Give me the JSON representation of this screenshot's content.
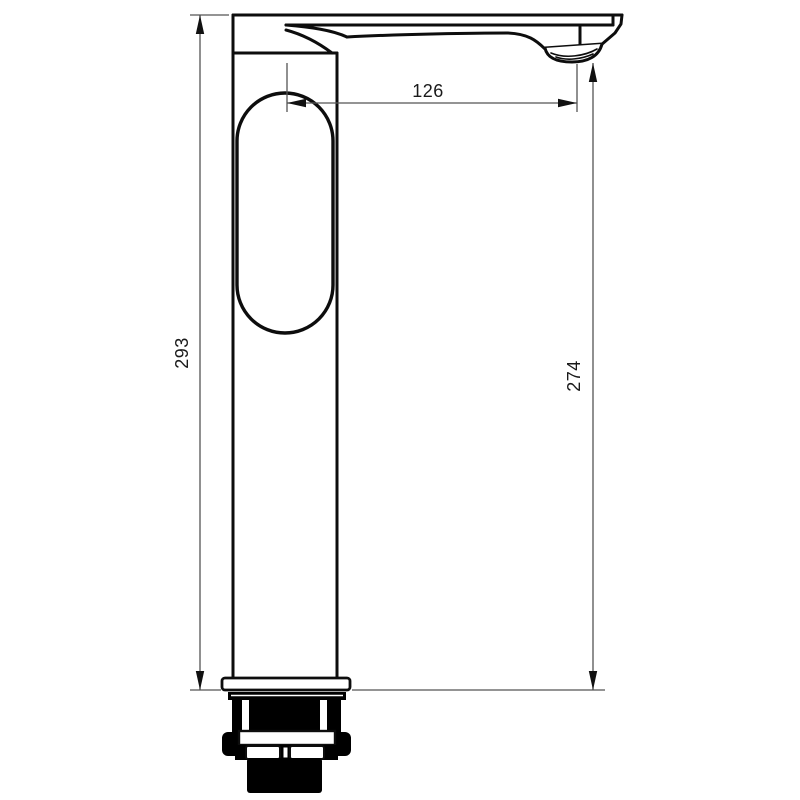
{
  "page": {
    "background": "#ffffff",
    "description": "Technical dimensioned drawing of a tall single-lever basin mixer tap, side view"
  },
  "drawing": {
    "subject": "Tall basin mixer tap - side elevation with dimensions",
    "units": "mm",
    "colors": {
      "outline": "#0d0d0d",
      "dimension_line": "#555555",
      "text": "#1a1a1a",
      "body_fill": "#ffffff",
      "hardware_fill": "#000000"
    },
    "dimensions": {
      "overall_height": {
        "value": "293",
        "orientation": "vertical",
        "position": "left",
        "measures": "overall height from mounting flange to top of lever"
      },
      "spout_reach": {
        "value": "126",
        "orientation": "horizontal",
        "position": "top",
        "measures": "horizontal reach from body axis to aerator outlet"
      },
      "spout_height": {
        "value": "274",
        "orientation": "vertical",
        "position": "right",
        "measures": "height from mounting flange to aerator outlet"
      }
    }
  }
}
